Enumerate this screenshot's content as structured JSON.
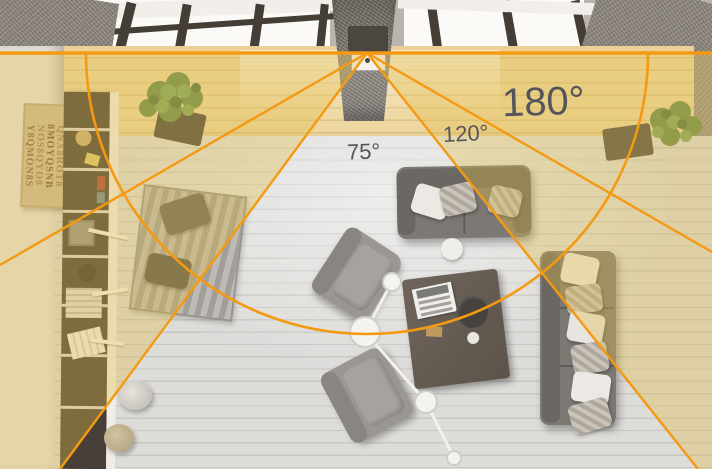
{
  "fov_overlay": {
    "angles": [
      {
        "label": "75°",
        "degrees": 75
      },
      {
        "label": "120°",
        "degrees": 120
      },
      {
        "label": "180°",
        "degrees": 180
      }
    ],
    "accent_color": "#F49A12",
    "highlight_tint_color": "rgba(228,197,98,0.42)",
    "label_color": "#53555A"
  },
  "wall_art": {
    "rows": [
      "S8NOQ8YM",
      "QNX8ROT8",
      "8MOYQSNB",
      "NOS8QYO8",
      "Y8QMON8S"
    ]
  }
}
